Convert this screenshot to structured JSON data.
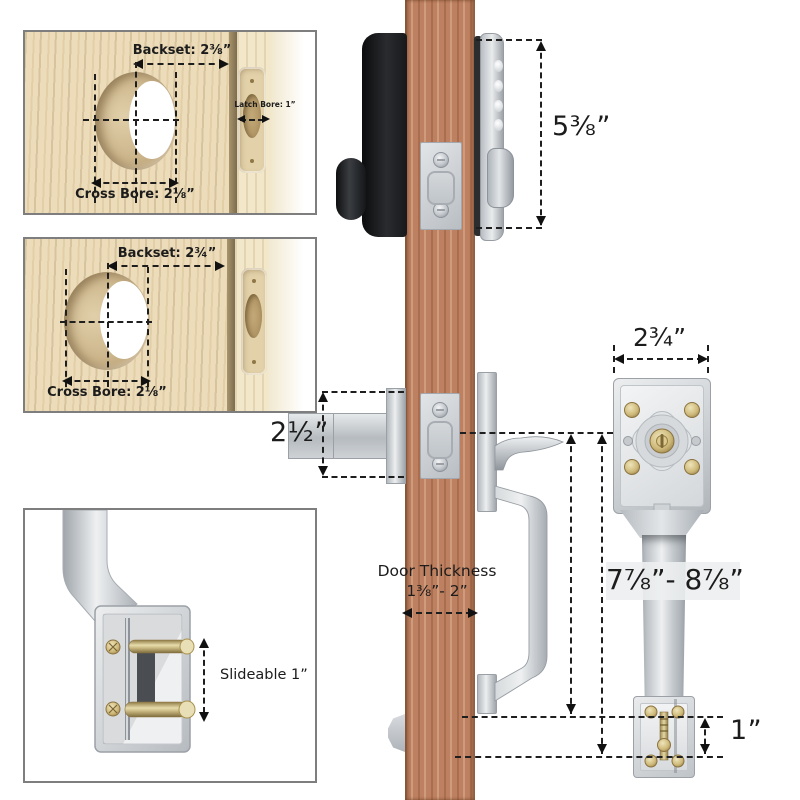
{
  "diagram": {
    "bore_top": {
      "backset": "Backset: 2⅜”",
      "latch_bore": "Latch Bore: 1”",
      "cross_bore": "Cross Bore: 2⅛”"
    },
    "bore_mid": {
      "backset": "Backset: 2¾”",
      "cross_bore": "Cross Bore: 2⅛”"
    },
    "handle_detail": {
      "slideable": "Slideable 1”"
    },
    "dims": {
      "lock_height": "5⅜”",
      "latch_length": "2½”",
      "plate_width": "2¾”",
      "handle_height": "7⅞”- 8⅞”",
      "door_thickness_title": "Door Thickness",
      "door_thickness_range": "1⅜”- 2”",
      "strike_adjust": "1”"
    }
  },
  "colors": {
    "door": "#bd8060",
    "wood": "#ecdcba",
    "hardware_silver": "#ccd0d4",
    "brass": "#c9b06e",
    "annotation": "#1e1e1e",
    "panel_black": "#1b1d1f",
    "background": "#ffffff"
  }
}
